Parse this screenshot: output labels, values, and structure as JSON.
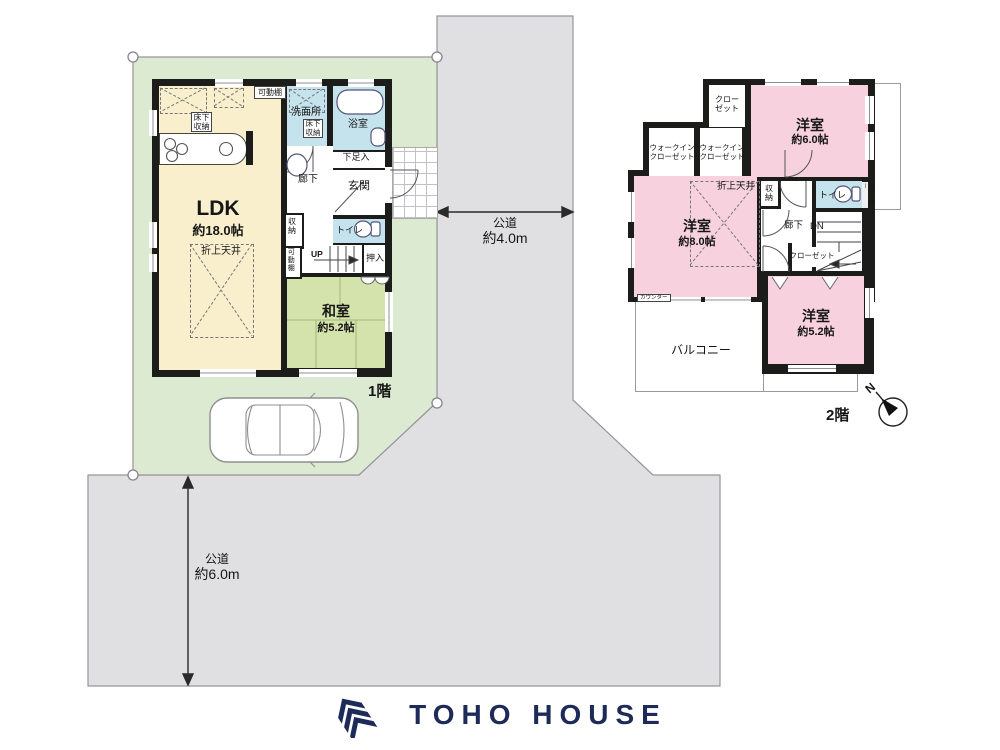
{
  "floor1": {
    "label": "1階",
    "ldk_name": "LDK",
    "ldk_size": "約18.0帖",
    "washitsu_name": "和室",
    "washitsu_size": "約5.2帖",
    "senmenjo": "洗面所",
    "yokushitsu": "浴室",
    "yukashita_kitchen": "床下収納",
    "yukashita_senmen": "床下収納",
    "kadoudana_top": "可動棚",
    "kadoudana_side": "可動棚",
    "getabako": "下足入",
    "genkan": "玄関",
    "rouka": "廊下",
    "shuunou": "収納",
    "toire": "トイレ",
    "up": "UP",
    "oshiire": "押入",
    "oriage_tenjou": "折上天井"
  },
  "floor2": {
    "label": "2階",
    "youshitsu6_name": "洋室",
    "youshitsu6_size": "約6.0帖",
    "youshitsu8_name": "洋室",
    "youshitsu8_size": "約8.0帖",
    "youshitsu5_name": "洋室",
    "youshitsu5_size": "約5.2帖",
    "closet_top": "クローゼット",
    "wic": "ウォークインクローゼット",
    "closet_mid": "クローゼット",
    "shuunou": "収納",
    "toire": "トイレ",
    "counter": "カウンター",
    "counter_win": "カウンター",
    "rouka": "廊下",
    "dn": "DN",
    "oriage_tenjou": "折上天井",
    "balcony": "バルコニー"
  },
  "roads": {
    "east_name": "公道",
    "east_width": "約4.0m",
    "south_name": "公道",
    "south_width": "約6.0m"
  },
  "compass": {
    "north": "N"
  },
  "logo": {
    "text": "TOHO HOUSE"
  },
  "colors": {
    "lot_green": "#dcead2",
    "road_gray": "#e0dfe2",
    "wall_black": "#1c1c1a",
    "ldk_cream": "#f9efcd",
    "tatami_green": "#d3e3ab",
    "wet_area_blue": "#c5e3ec",
    "bedroom_pink": "#f7d2de",
    "logo_navy": "#1e2b59"
  }
}
